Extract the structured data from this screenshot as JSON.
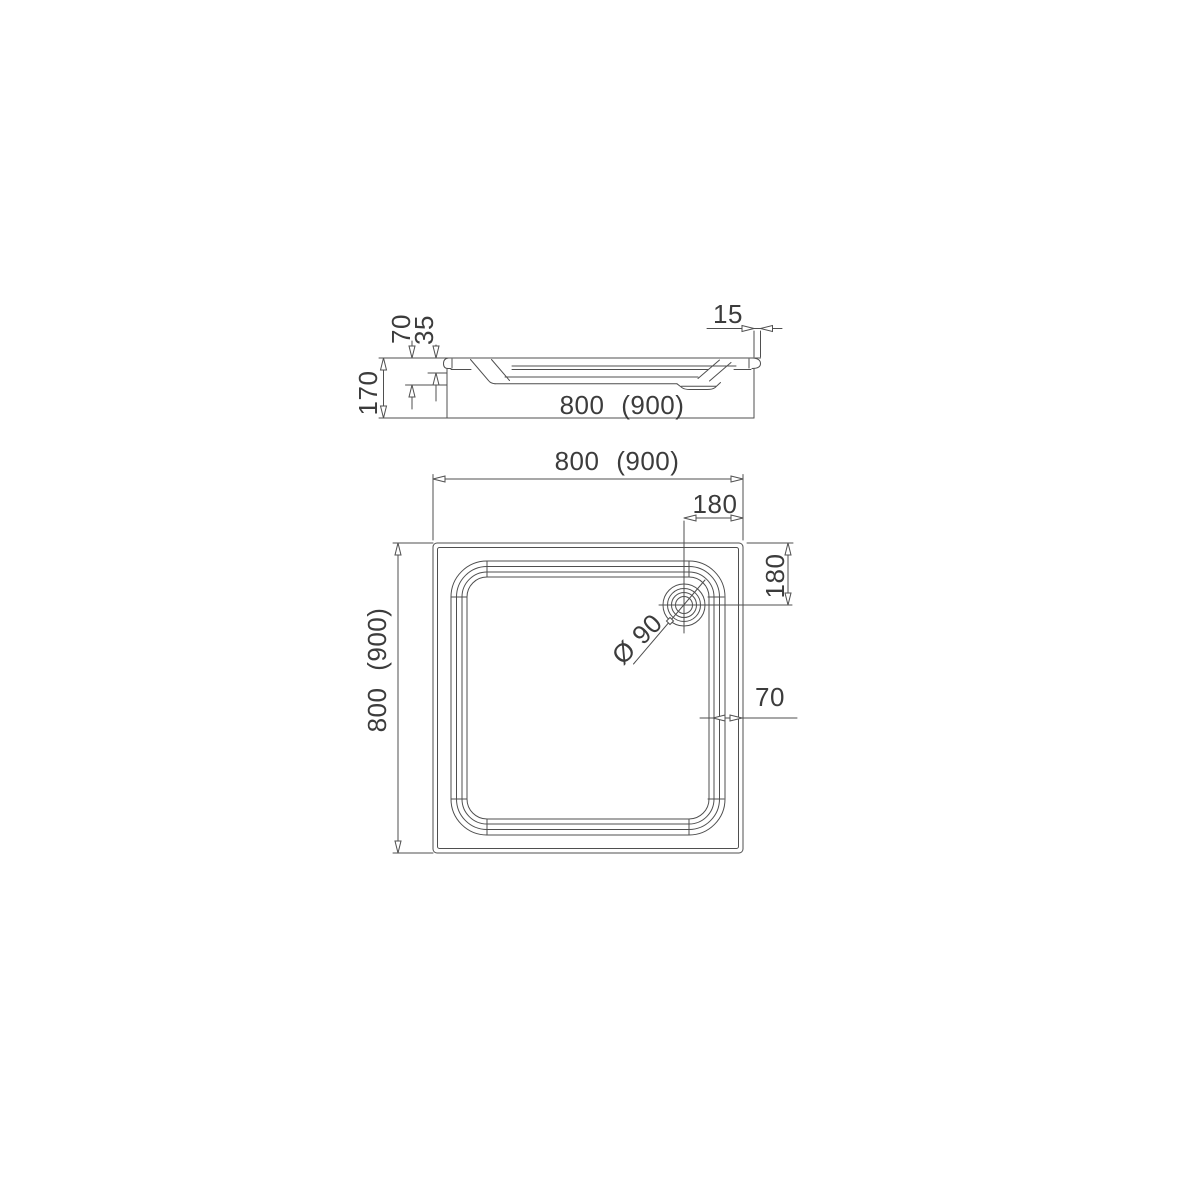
{
  "drawing": {
    "subject": "Square shower tray with corner drain - dimensioned technical drawing (side elevation and plan view)",
    "side": {
      "rim_height": "70",
      "inner_depth": "35",
      "total_height": "170",
      "edge_offset": "15",
      "width": "800 (900)"
    },
    "plan": {
      "width": "800 (900)",
      "depth": "800 (900)",
      "drain_offset_from_right": "180",
      "drain_offset_from_top": "180",
      "drain_diameter": "Ø 90",
      "rim_width": "70"
    },
    "colors": {
      "line": "#4f4f4f",
      "text": "#3c3c3c",
      "background": "#ffffff"
    }
  }
}
